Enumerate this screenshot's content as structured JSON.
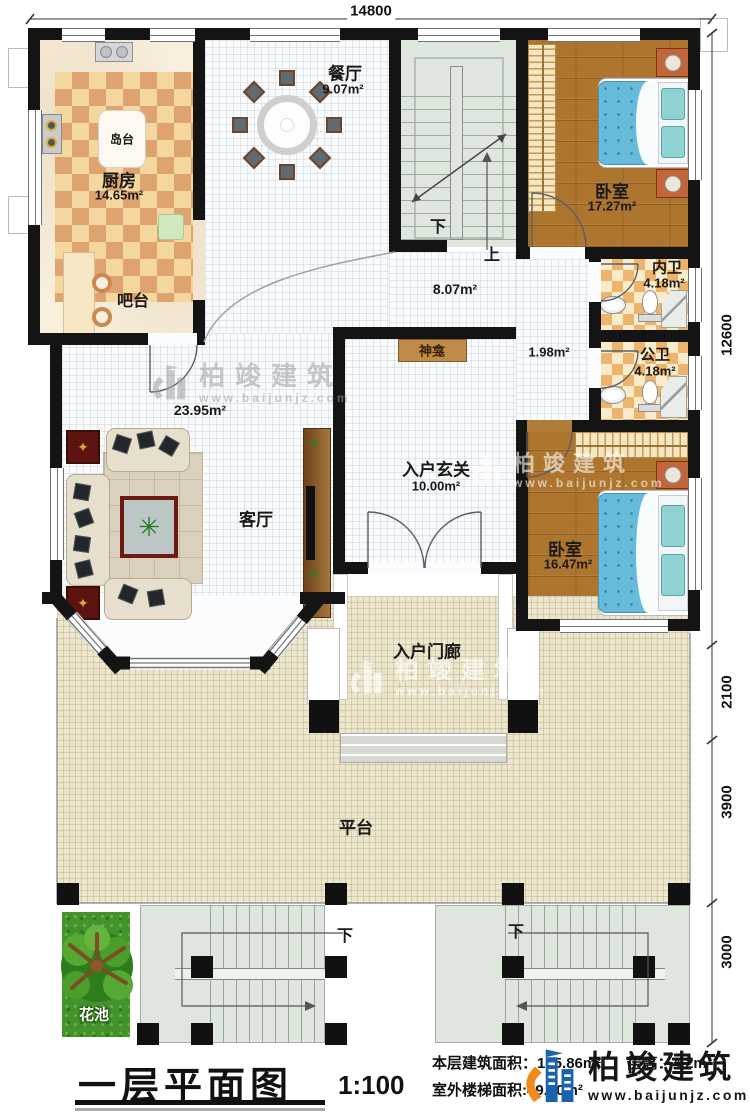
{
  "dimensions": {
    "top": "14800",
    "right": [
      "12600",
      "2100",
      "3900",
      "3000"
    ]
  },
  "rooms": {
    "kitchen": {
      "name": "厨房",
      "area": "14.65m²"
    },
    "island": {
      "name": "岛台"
    },
    "dining": {
      "name": "餐厅",
      "area": "9.07m²"
    },
    "bar": {
      "name": "吧台"
    },
    "living": {
      "name": "客厅",
      "area": "23.95m²"
    },
    "hall": {
      "area": "8.07m²"
    },
    "corridor": {
      "area": "1.98m²"
    },
    "shrine": {
      "name": "神龛"
    },
    "foyer": {
      "name": "入户玄关",
      "area": "10.00m²"
    },
    "bedroom1": {
      "name": "卧室",
      "area": "17.27m²"
    },
    "ensuite": {
      "name": "内卫",
      "area": "4.18m²"
    },
    "bath": {
      "name": "公卫",
      "area": "4.18m²"
    },
    "bedroom2": {
      "name": "卧室",
      "area": "16.47m²"
    },
    "porch": {
      "name": "入户门廊"
    },
    "platform": {
      "name": "平台"
    },
    "flowerbed": {
      "name": "花池"
    }
  },
  "stairs": {
    "down": "下",
    "up": "上"
  },
  "titleblock": {
    "title": "一层平面图",
    "scale": "1:100",
    "built_area": "本层建筑面积：185.86m²",
    "floor_height": "层高：4.2m",
    "stair_area": "室外楼梯面积:49.10m²"
  },
  "brand": {
    "name": "柏竣建筑",
    "site": "www.baijunjz.com"
  }
}
